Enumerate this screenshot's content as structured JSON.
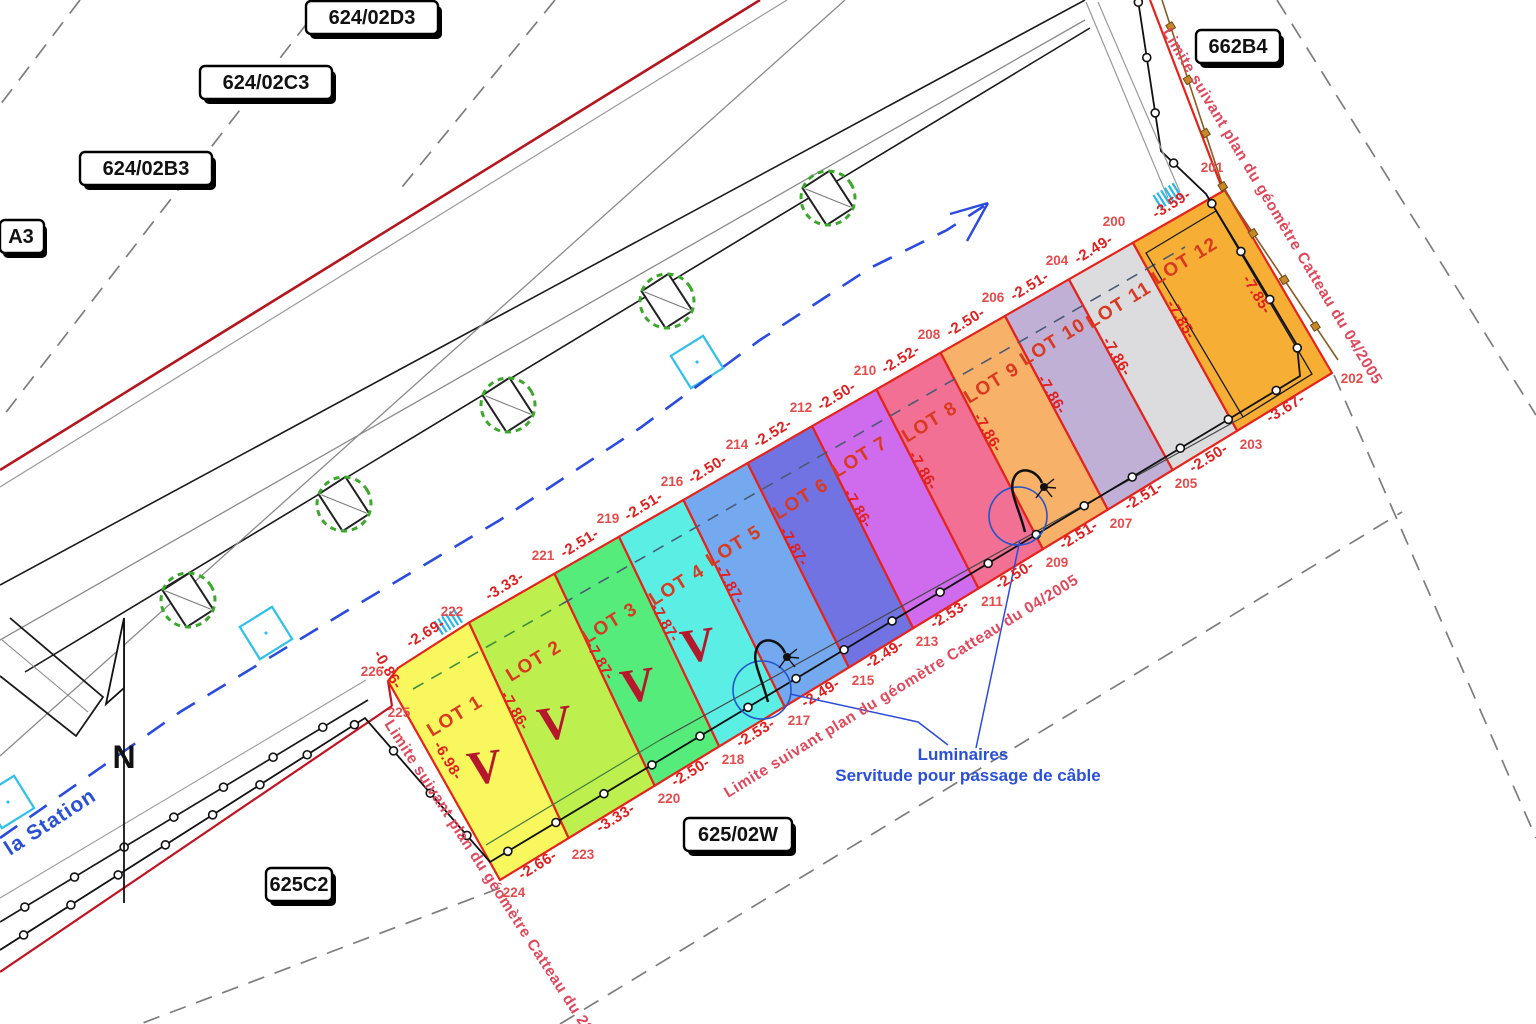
{
  "plan": {
    "parcels": {
      "d3": "624/02D3",
      "c3": "624/02C3",
      "b3": "624/02B3",
      "a3": "A3",
      "b4": "662B4",
      "w": "625/02W",
      "c2": "625C2"
    },
    "street": "la Station",
    "north": "N",
    "notes": {
      "limite_right": "Limite suivant plan du géomètre Catteau du 04/2005",
      "limite_bottom": "Limite suivant plan du géomètre Catteau du 04/2005",
      "limite_southwest": "Limite suivant plan du géomètre Catteau du 28/",
      "luminaires": "Luminaires",
      "servitude": "Servitude pour passage de câble"
    },
    "lots": [
      {
        "name": "LOT 1",
        "top": "-2.69-",
        "bottom": "-2.66-",
        "color": "#f8f75e",
        "mark": "V"
      },
      {
        "name": "LOT 2",
        "top": "-3.33-",
        "bottom": "-3.33-",
        "color": "#bdf04e",
        "mark": "V"
      },
      {
        "name": "LOT 3",
        "top": "-2.51-",
        "bottom": "-2.50-",
        "color": "#55ec7b",
        "mark": "V"
      },
      {
        "name": "LOT 4",
        "top": "-2.51-",
        "bottom": "-2.53-",
        "color": "#5beee4",
        "mark": "V"
      },
      {
        "name": "LOT 5",
        "top": "-2.50-",
        "bottom": "-2.49-",
        "color": "#74a9f0"
      },
      {
        "name": "LOT 6",
        "top": "-2.52-",
        "bottom": "-2.49-",
        "color": "#7273e2"
      },
      {
        "name": "LOT 7",
        "top": "-2.50-",
        "bottom": "-2.53-",
        "color": "#cf6cee"
      },
      {
        "name": "LOT 8",
        "top": "-2.52-",
        "bottom": "-2.50-",
        "color": "#f27093"
      },
      {
        "name": "LOT 9",
        "top": "-2.50-",
        "bottom": "-2.51-",
        "color": "#f8b169"
      },
      {
        "name": "LOT 10",
        "top": "-2.51-",
        "bottom": "-2.51-",
        "color": "#c0b0d5"
      },
      {
        "name": "LOT 11",
        "top": "-2.49-",
        "bottom": "-2.50-",
        "color": "#dcdcde"
      },
      {
        "name": "LOT 12",
        "top": "-3.59-",
        "bottom": "-3.67-",
        "color": "#f7ae35"
      }
    ],
    "depths": [
      "-7.86-",
      "-7.87-",
      "-7.87-",
      "-7.87-",
      "-7.87-",
      "-7.86-",
      "-7.86-",
      "-7.86-",
      "-7.86-",
      "-7.86-",
      "-7.85-"
    ],
    "edge_measures": {
      "lot1_bevel": "-0.86-",
      "lot1_left": "-6.98-",
      "lot12_fence": "-7.85-"
    },
    "points_top": [
      "226",
      "225",
      "222",
      "221",
      "219",
      "216",
      "214",
      "212",
      "210",
      "208",
      "206",
      "204",
      "200",
      "201"
    ],
    "points_bottom": [
      "224",
      "223",
      "220",
      "218",
      "217",
      "215",
      "213",
      "211",
      "209",
      "207",
      "205",
      "203",
      "202"
    ],
    "colors": {
      "lot_border": "#e5231b",
      "limit_red_line": "#b5161d",
      "blue_annotation": "#2b50d8",
      "fence_brown": "#8a5a22",
      "tree_green": "#3aa829",
      "cyan_symbol": "#28b6e8"
    }
  }
}
